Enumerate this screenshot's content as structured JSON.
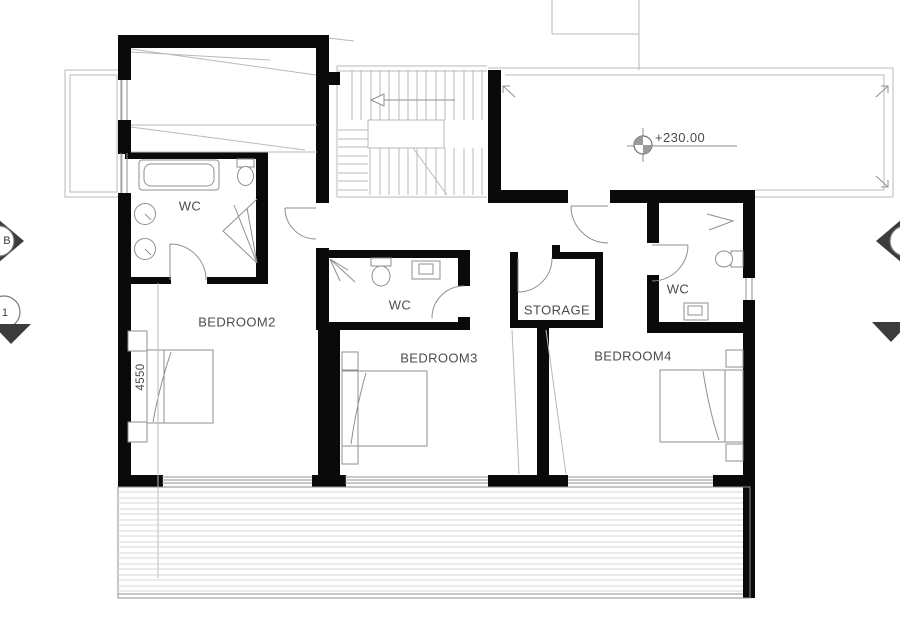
{
  "drawing": {
    "type": "architectural-floor-plan",
    "rooms": {
      "bedroom2": {
        "label": "BEDROOM2"
      },
      "bedroom3": {
        "label": "BEDROOM3"
      },
      "bedroom4": {
        "label": "BEDROOM4"
      },
      "storage": {
        "label": "STORAGE"
      },
      "wc_master": {
        "label": "WC"
      },
      "wc_bedroom3": {
        "label": "WC"
      },
      "wc_bedroom4": {
        "label": "WC"
      }
    },
    "annotations": {
      "balcony_level": "+230.00",
      "bedroom2_dimension": "4550",
      "section_marker_b": "B",
      "section_marker_1": "1"
    }
  },
  "colors": {
    "wall": "#0a0a0a",
    "line_light": "#b9b9b9",
    "line_mid": "#8f8f8f",
    "deck_line": "#d6d6d6",
    "text": "#4c4c4c",
    "marker_fill": "#3c3c3c"
  }
}
